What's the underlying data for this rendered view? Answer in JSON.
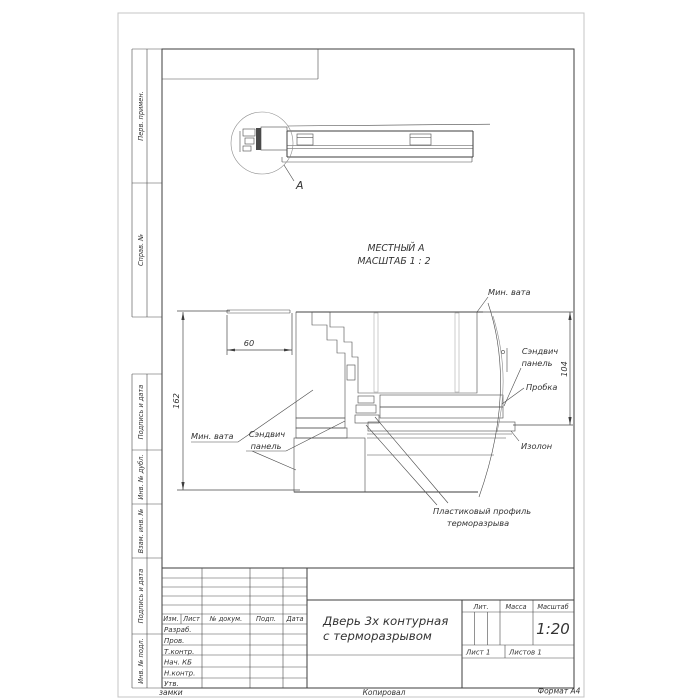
{
  "sheet": {
    "watermark_left": "замки",
    "copied": "Копировал",
    "format": "Формат А4"
  },
  "side_columns": {
    "perv_primen": "Перв. примен.",
    "sprav_no": "Справ. №",
    "podpis_i_data_top": "Подпись и дата",
    "inv_no_dubl": "Инв. № дубл.",
    "vzam_inv_no": "Взам. инв. №",
    "podpis_i_data_bottom": "Подпись и дата",
    "inv_no_podl": "Инв. № подл."
  },
  "title_block": {
    "col_izm": "Изм.",
    "col_list": "Лист",
    "col_doc": "№ докум.",
    "col_podp": "Подп.",
    "col_data": "Дата",
    "row_razrab": "Разраб.",
    "row_prov": "Пров.",
    "row_tkontr": "Т.контр.",
    "row_nachkb": "Нач. КБ",
    "row_nkontr": "Н.контр.",
    "row_utv": "Утв.",
    "title_line1": "Дверь 3х контурная",
    "title_line2": "с терморазрывом",
    "lit": "Лит.",
    "massa": "Масса",
    "masshtab": "Масштаб",
    "scale": "1:20",
    "list_no": "Лист 1",
    "listov": "Листов 1"
  },
  "views": {
    "callout": "А",
    "local_view_line1": "МЕСТНЫЙ А",
    "local_view_line2": "МАСШТАБ 1 : 2"
  },
  "dimensions": {
    "d60": "60",
    "d162": "162",
    "d104": "104"
  },
  "part_labels": {
    "min_vata_left": "Мин. вата",
    "sandwich_left_l1": "Сэндвич",
    "sandwich_left_l2": "панель",
    "min_vata_top": "Мин. вата",
    "sandwich_right_l1": "Сэндвич",
    "sandwich_right_l2": "панель",
    "probka": "Пробка",
    "izolon": "Изолон",
    "plastic_l1": "Пластиковый профиль",
    "plastic_l2": "терморазрыва"
  },
  "colors": {
    "line": "#3e3e3e",
    "hatch": "#6f6f6f",
    "page_border": "#c4c4c4"
  }
}
